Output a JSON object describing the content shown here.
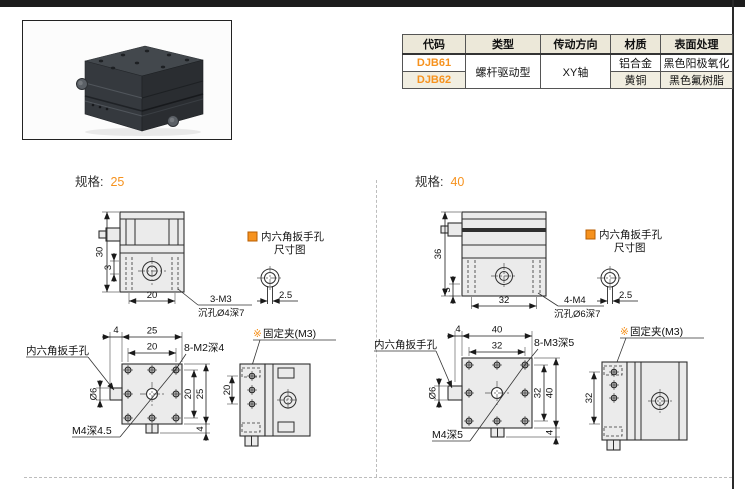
{
  "colors": {
    "accent": "#F6921E",
    "table_header_bg": "#ECE8D9",
    "table_alt_bg": "#F1EEE1",
    "drawing_fill": "#EBEBEB"
  },
  "spec_table": {
    "headers": [
      "代码",
      "类型",
      "传动方向",
      "材质",
      "表面处理"
    ],
    "row1": {
      "code": "DJB61",
      "type": "螺杆驱动型",
      "direction": "XY轴",
      "material": "铝合金",
      "surface": "黑色阳极氧化"
    },
    "row2": {
      "code": "DJB62",
      "material": "黄铜",
      "surface": "黑色氟树脂"
    }
  },
  "spec25": {
    "title_label": "规格:",
    "title_value": "25",
    "front": {
      "dim_height": "30",
      "dim_lip": "3",
      "dim_width": "20",
      "thread": "3-M3",
      "counterbore": "沉孔Ø4深7"
    },
    "hex_note": {
      "line1": "内六角扳手孔",
      "line2": "尺寸图",
      "dim": "2.5"
    },
    "top": {
      "dim_offset": "4",
      "dim_outer_top": "25",
      "dim_inner_top": "20",
      "thread": "8-M2深4",
      "wrench_label": "内六角扳手孔",
      "dim_dia": "Ø6",
      "center_thread": "M4深4.5",
      "dim_inner_right": "20",
      "dim_outer_right": "25",
      "dim_tab": "4"
    },
    "side": {
      "marker": "※",
      "clamp_label": "固定夹(M3)",
      "dim_height": "20"
    }
  },
  "spec40": {
    "title_label": "规格:",
    "title_value": "40",
    "front": {
      "dim_height": "36",
      "dim_lip": "5",
      "dim_width": "32",
      "thread": "4-M4",
      "counterbore": "沉孔Ø6深7"
    },
    "hex_note": {
      "line1": "内六角扳手孔",
      "line2": "尺寸图",
      "dim": "2.5"
    },
    "top": {
      "dim_offset": "4",
      "dim_outer_top": "40",
      "dim_inner_top": "32",
      "thread": "8-M3深5",
      "wrench_label": "内六角扳手孔",
      "dim_dia": "Ø6",
      "center_thread": "M4深5",
      "dim_inner_right": "32",
      "dim_outer_right": "40",
      "dim_tab": "4"
    },
    "side": {
      "marker": "※",
      "clamp_label": "固定夹(M3)",
      "dim_height": "32"
    }
  }
}
